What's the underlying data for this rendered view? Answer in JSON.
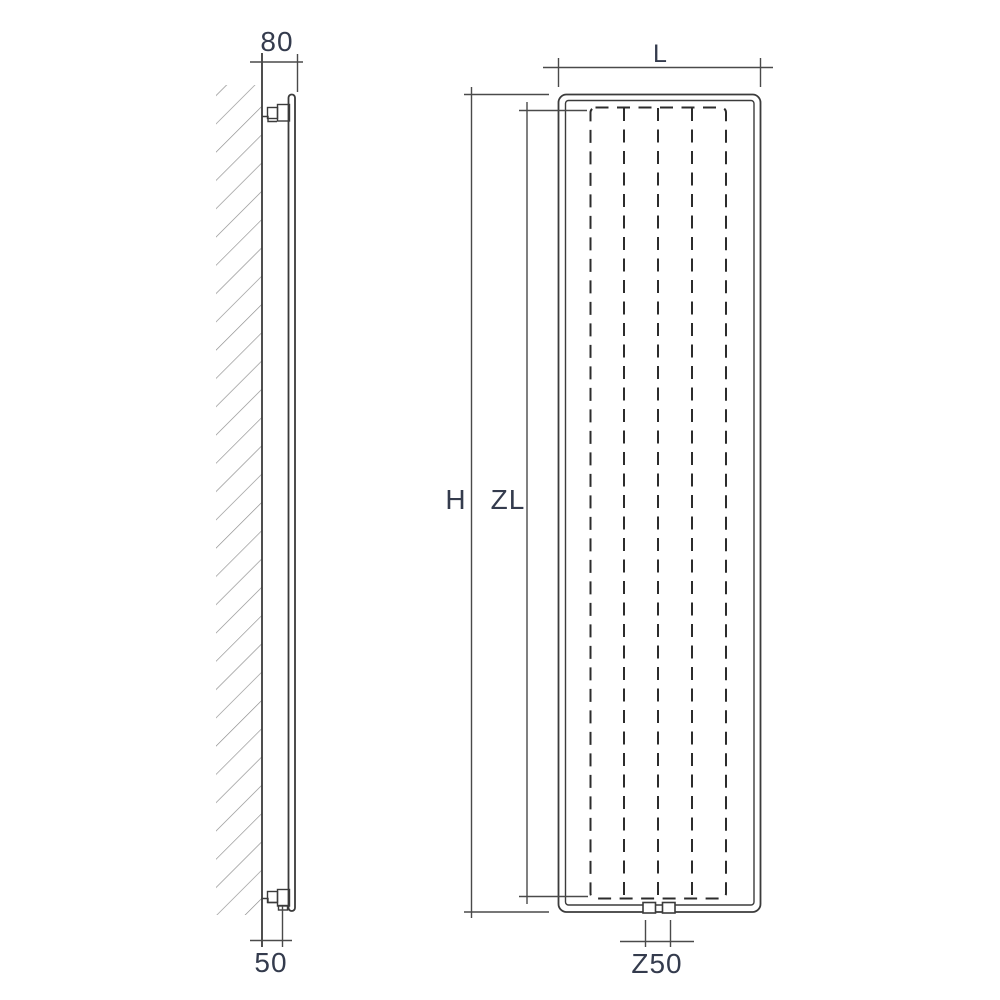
{
  "colors": {
    "bg": "#ffffff",
    "line": "#3b3b3b",
    "dim": "#4a4a4a",
    "hidden": "#2c2c2c",
    "hatch": "#8c8c8c",
    "text": "#343b4d"
  },
  "side_view": {
    "dim_top": "80",
    "dim_bottom": "50"
  },
  "front_view": {
    "dim_width": "L",
    "dim_height": "H",
    "dim_inner_height": "ZL",
    "dim_connection": "Z50"
  }
}
